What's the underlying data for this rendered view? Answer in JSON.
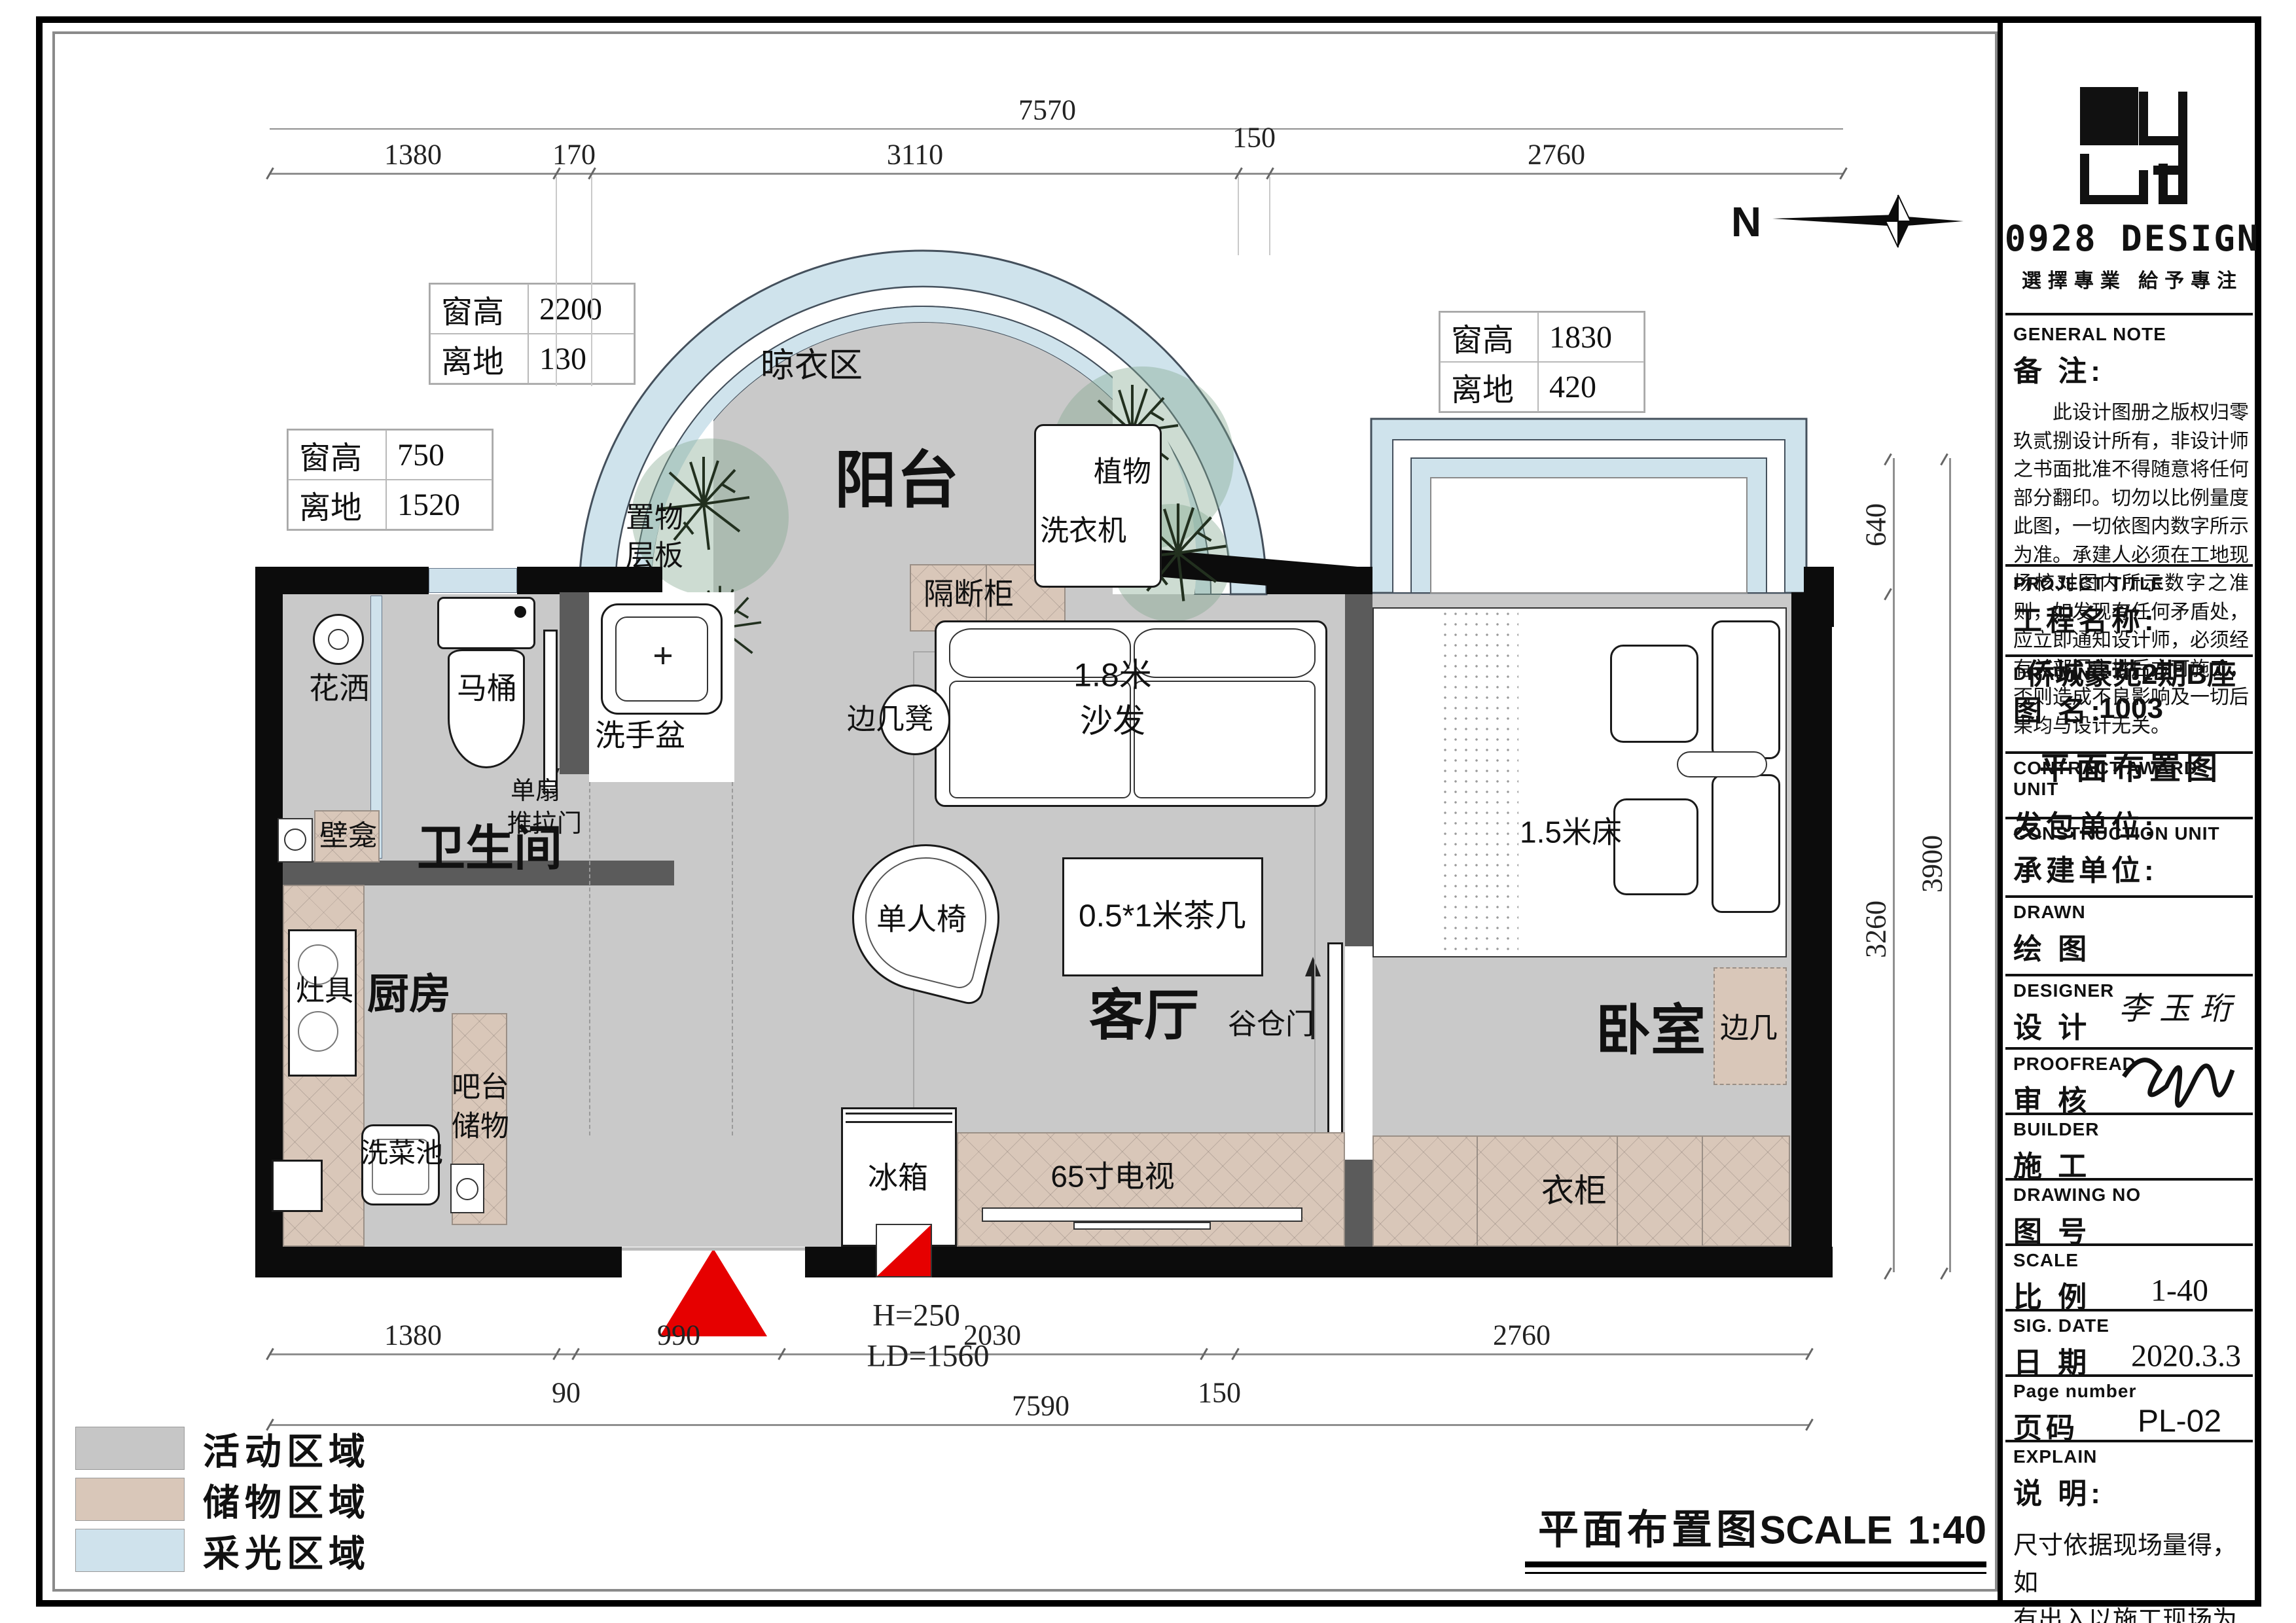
{
  "compass": {
    "n": "N"
  },
  "brand": {
    "name": "0928 DESIGN",
    "tagline": "選擇專業 給予專注"
  },
  "footer": {
    "title": "平面布置图",
    "scale_word": "SCALE",
    "scale_value": "1:40"
  },
  "legend": {
    "items": [
      {
        "label": "活动区域",
        "color": "#c6c6c6"
      },
      {
        "label": "储物区域",
        "color": "#d9c7b9"
      },
      {
        "label": "采光区域",
        "color": "#cfe2ec"
      }
    ]
  },
  "dims": {
    "top_total": "7570",
    "top": [
      "1380",
      "170",
      "3110",
      "150",
      "2760"
    ],
    "bottom": [
      "1380",
      "990",
      "2030",
      "2760"
    ],
    "bottom_small": [
      "90",
      "150"
    ],
    "bottom_total": "7590",
    "right": [
      "640",
      "3260"
    ],
    "right_total": "3900",
    "entry_h": "H=250",
    "entry_ld": "LD=1560"
  },
  "window_notes": {
    "balcony": {
      "r1l": "窗高",
      "r1v": "2200",
      "r2l": "离地",
      "r2v": "130"
    },
    "left": {
      "r1l": "窗高",
      "r1v": "750",
      "r2l": "离地",
      "r2v": "1520"
    },
    "bedroom": {
      "r1l": "窗高",
      "r1v": "1830",
      "r2l": "离地",
      "r2v": "420"
    }
  },
  "rooms": {
    "drying": "晾衣区",
    "balcony": "阳台",
    "bathroom": "卫生间",
    "kitchen": "厨房",
    "living": "客厅",
    "bedroom": "卧室"
  },
  "fixtures": {
    "shelf1": "置物",
    "shelf2": "层板",
    "plant": "植物",
    "washer": "洗衣机",
    "partition_cabinet": "隔断柜",
    "side_stool": "边几凳",
    "sofa1": "1.8米",
    "sofa2": "沙发",
    "tea_table": "0.5*1米茶几",
    "armchair": "单人椅",
    "shower": "花洒",
    "toilet": "马桶",
    "basin": "洗手盆",
    "sliding1": "单扇",
    "sliding2": "推拉门",
    "niche": "壁龛",
    "stove": "灶具",
    "bar1": "吧台",
    "bar2": "储物",
    "sink": "洗菜池",
    "fridge": "冰箱",
    "tv": "65寸电视",
    "barn_door": "谷仓门",
    "wardrobe": "衣柜",
    "side_table": "边几",
    "bed": "1.5米床"
  },
  "titleblock": {
    "general_note": {
      "en": "GENERAL NOTE",
      "zh": "备 注:",
      "body": "此设计图册之版权归零玖贰捌设计所有，非设计师之书面批准不得随意将任何部分翻印。切勿以比例量度此图，一切依图内数字所示为准。承建人必须在工地现场核对图内所示数字之准则，如发现有任何矛盾处，应立即通知设计师，必须经有关部门审批后方可施工，否则造成不良影响及一切后果均与设计无关。"
    },
    "project": {
      "en": "PROJECT TITLE",
      "zh": "工程名称:",
      "value": "侨城豪苑2期B座1003"
    },
    "drawing": {
      "en": "DRAWING TITLE",
      "zh": "图  名:",
      "value": "平面布置图"
    },
    "contract": {
      "en": "CONTRACT AWARD UNIT",
      "zh": "发包单位:"
    },
    "construction": {
      "en": "CONSTRUCTION UNIT",
      "zh": "承建单位:"
    },
    "drawn": {
      "en": "DRAWN",
      "zh": "绘  图"
    },
    "designer": {
      "en": "DESIGNER",
      "zh": "设  计",
      "value": "李玉珩"
    },
    "proofread": {
      "en": "PROOFREAD",
      "zh": "审  核"
    },
    "builder": {
      "en": "BUILDER",
      "zh": "施  工"
    },
    "drawing_no": {
      "en": "DRAWING NO",
      "zh": "图  号"
    },
    "scale": {
      "en": "SCALE",
      "zh": "比  例",
      "value": "1-40"
    },
    "date": {
      "en": "SIG. DATE",
      "zh": "日  期",
      "value": "2020.3.3"
    },
    "page_no": {
      "en": "Page number",
      "zh": "页码",
      "value": "PL-02"
    },
    "explain": {
      "en": "EXPLAIN",
      "zh": "说  明:",
      "line1": "尺寸依据现场量得，如",
      "line2": "有出入以施工现场为准。"
    }
  }
}
